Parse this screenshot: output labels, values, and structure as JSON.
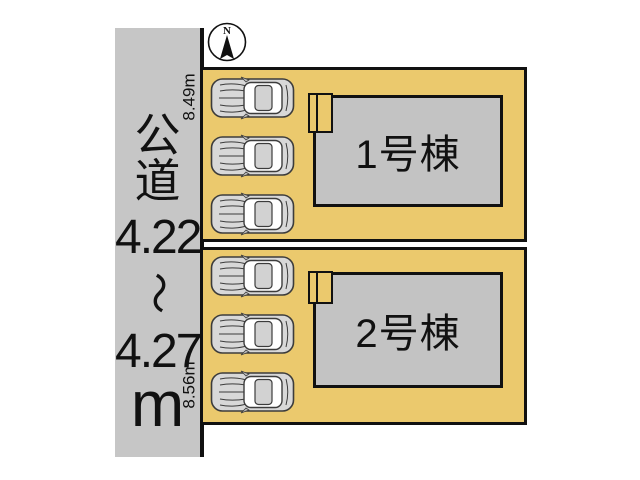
{
  "compass": {
    "label": "N"
  },
  "road": {
    "name_vertical": [
      "公",
      "道"
    ],
    "width_min": "4.22",
    "range_symbol": "～",
    "width_max": "4.27",
    "unit": "m"
  },
  "plots": [
    {
      "frontage": "8.49m",
      "building_label": "1号棟",
      "car_count": 3
    },
    {
      "frontage": "8.56m",
      "building_label": "2号棟",
      "car_count": 3
    }
  ],
  "colors": {
    "plot_fill": "#ebc96d",
    "road_fill": "#c6c6c6",
    "building_fill": "#c3c3c3",
    "outline": "#111111"
  }
}
